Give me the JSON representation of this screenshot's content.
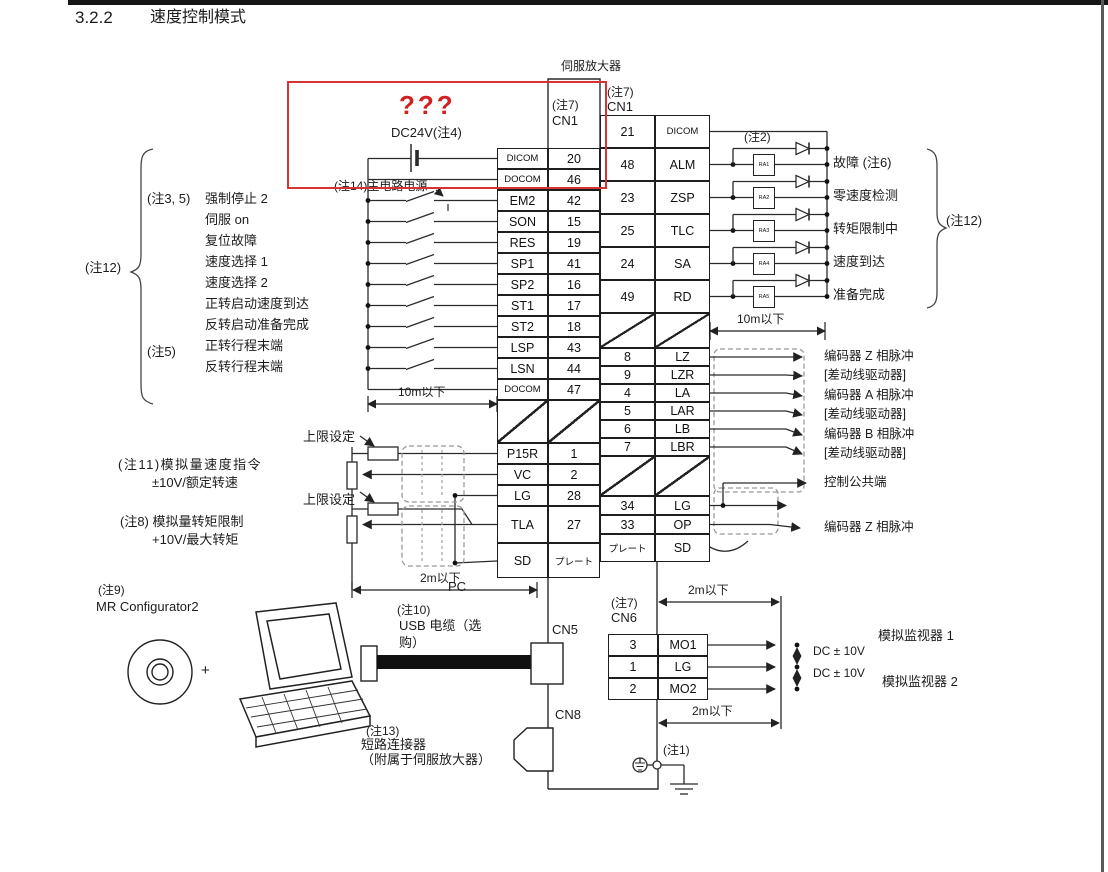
{
  "page": {
    "section_number": "3.2.2",
    "section_title": "速度控制模式",
    "amplifier_label": "伺服放大器",
    "red_annotation": "???",
    "dc_supply_label": "DC24V(注4)"
  },
  "cn1_left": {
    "header": "(注7)",
    "connector": "CN1",
    "rows": [
      {
        "name": "DICOM",
        "pin": "20"
      },
      {
        "name": "DOCOM",
        "pin": "46"
      },
      {
        "name": "EM2",
        "pin": "42"
      },
      {
        "name": "SON",
        "pin": "15"
      },
      {
        "name": "RES",
        "pin": "19"
      },
      {
        "name": "SP1",
        "pin": "41"
      },
      {
        "name": "SP2",
        "pin": "16"
      },
      {
        "name": "ST1",
        "pin": "17"
      },
      {
        "name": "ST2",
        "pin": "18"
      },
      {
        "name": "LSP",
        "pin": "43"
      },
      {
        "name": "LSN",
        "pin": "44"
      },
      {
        "name": "DOCOM",
        "pin": "47"
      },
      {
        "name": "P15R",
        "pin": "1"
      },
      {
        "name": "VC",
        "pin": "2"
      },
      {
        "name": "LG",
        "pin": "28"
      },
      {
        "name": "TLA",
        "pin": "27"
      },
      {
        "name": "SD",
        "pin": "プレート"
      }
    ]
  },
  "cn1_right": {
    "header": "(注7)",
    "connector": "CN1",
    "rows": [
      {
        "pin": "21",
        "name": "DICOM"
      },
      {
        "pin": "48",
        "name": "ALM"
      },
      {
        "pin": "23",
        "name": "ZSP"
      },
      {
        "pin": "25",
        "name": "TLC"
      },
      {
        "pin": "24",
        "name": "SA"
      },
      {
        "pin": "49",
        "name": "RD"
      },
      {
        "pin": "8",
        "name": "LZ"
      },
      {
        "pin": "9",
        "name": "LZR"
      },
      {
        "pin": "4",
        "name": "LA"
      },
      {
        "pin": "5",
        "name": "LAR"
      },
      {
        "pin": "6",
        "name": "LB"
      },
      {
        "pin": "7",
        "name": "LBR"
      },
      {
        "pin": "34",
        "name": "LG"
      },
      {
        "pin": "33",
        "name": "OP"
      },
      {
        "pin": "プレート",
        "name": "SD"
      }
    ]
  },
  "cn6": {
    "header": "(注7)",
    "connector": "CN6",
    "rows": [
      {
        "pin": "3",
        "name": "MO1"
      },
      {
        "pin": "1",
        "name": "LG"
      },
      {
        "pin": "2",
        "name": "MO2"
      }
    ]
  },
  "inputs": {
    "bracket_note": "(注12)",
    "note_prefix": "(注3, 5)",
    "note5": "(注5)",
    "main_power_note": "(注14)主电路电源",
    "cable_length": "10m以下",
    "labels": [
      "强制停止 2",
      "伺服 on",
      "复位故障",
      "速度选择 1",
      "速度选择 2",
      "正转启动速度到达",
      "反转启动准备完成",
      "正转行程末端",
      "反转行程末端"
    ]
  },
  "analog": {
    "upper_limit": "上限设定",
    "speed_note": "(注11)模拟量速度指令",
    "speed_range": "±10V/额定转速",
    "torque_note": "(注8) 模拟量转矩限制",
    "torque_range": "+10V/最大转矩",
    "cable_length": "2m以下"
  },
  "outputs": {
    "note2": "(注2)",
    "note12": "(注12)",
    "cable_length": "10m以下",
    "relays": [
      "RA1",
      "RA2",
      "RA3",
      "RA4",
      "RA5"
    ],
    "labels": [
      "故障 (注6)",
      "零速度检测",
      "转矩限制中",
      "速度到达",
      "准备完成"
    ]
  },
  "encoder": {
    "labels": [
      "编码器 Z 相脉冲",
      "[差动线驱动器]",
      "编码器 A 相脉冲",
      "[差动线驱动器]",
      "编码器 B 相脉冲",
      "[差动线驱动器]",
      "控制公共端",
      "编码器 Z 相脉冲"
    ]
  },
  "monitor": {
    "dc_range": "DC ± 10V",
    "monitor1": "模拟监视器 1",
    "monitor2": "模拟监视器 2",
    "cable_length_top": "2m以下",
    "cable_length_bottom": "2m以下"
  },
  "pc": {
    "note9": "(注9)",
    "software": "MR Configurator2",
    "pc_label": "PC",
    "plus": "+",
    "note10": "(注10)",
    "usb_line1": "USB 电缆（选",
    "usb_line2": "购）",
    "cn5": "CN5",
    "cn8": "CN8",
    "note13": "(注13)",
    "short_connector_line1": "短路连接器",
    "short_connector_line2": "（附属于伺服放大器）"
  },
  "ground": {
    "note1": "(注1)"
  },
  "colors": {
    "annotation_red": "#d63434",
    "diagram_line": "#2a2a2a",
    "page_edge": "#5a5a5a"
  }
}
